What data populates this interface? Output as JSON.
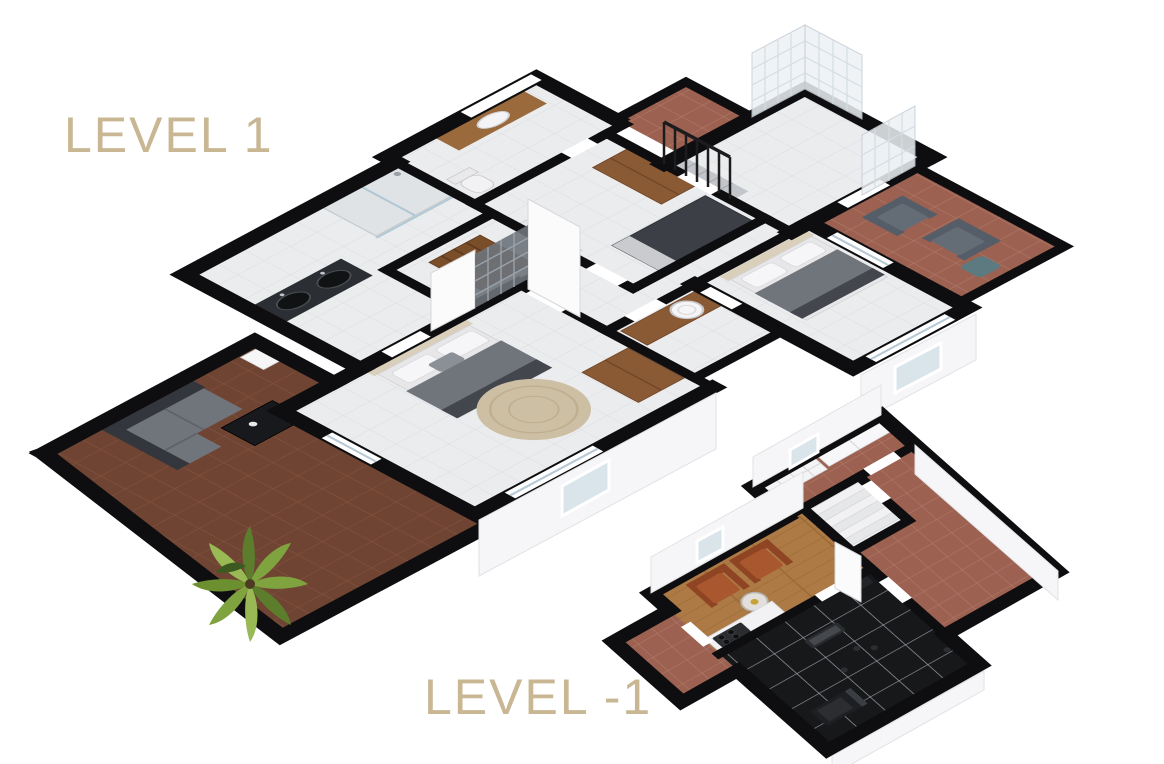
{
  "page": {
    "background": "#ffffff",
    "width": 1164,
    "height": 764
  },
  "levels": [
    {
      "label": "LEVEL 1"
    },
    {
      "label": "LEVEL -1"
    }
  ],
  "palette": {
    "label_text": "#c9b794",
    "wall": "#0e0e10",
    "terrace_tile": "#6f4433",
    "terracotta_tile": "#9c6151",
    "balcony_tile": "#a1644f",
    "gym_tile": "#17181a",
    "wood_floor": "#ad7a45",
    "interior_floor": "#ebecee",
    "bed_duvet": "#70747b",
    "bed_headboard": "#d9cfba",
    "rug": "#cdbfa4",
    "wardrobe_wood": "#8a5a35",
    "outdoor_sofa": "#33373d",
    "armchair_gray": "#646d76",
    "armchair_rust": "#a9572e",
    "window_glass": "#d9e5eb",
    "glass_block": "#eef2f5",
    "plant_green": "#7fa33e"
  }
}
